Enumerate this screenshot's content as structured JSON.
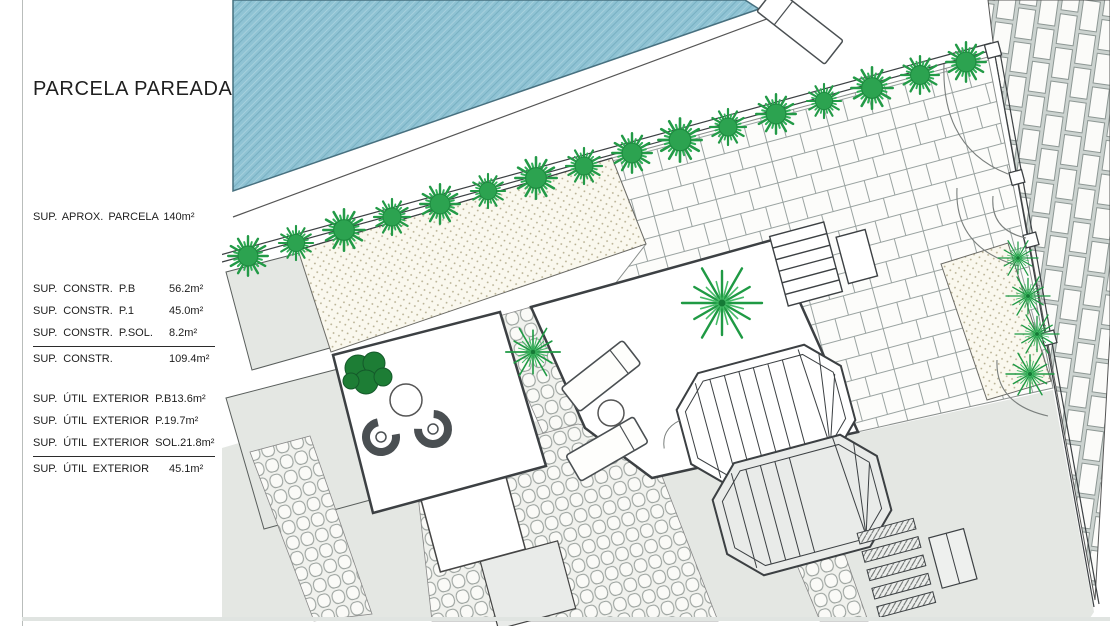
{
  "panel": {
    "title": "PARCELA PAREADA",
    "parcel_area": "SUP. APROX. PARCELA 140m²",
    "constructed": {
      "rows": [
        {
          "label": "SUP. CONSTR. P.B",
          "value": "56.2m²"
        },
        {
          "label": "SUP. CONSTR. P.1",
          "value": "45.0m²"
        },
        {
          "label": "SUP. CONSTR. P.SOL.",
          "value": "8.2m²"
        }
      ],
      "total": {
        "label": "SUP. CONSTR.",
        "value": "109.4m²"
      }
    },
    "exterior": {
      "rows": [
        {
          "label": "SUP. ÚTIL EXTERIOR P.B",
          "value": "13.6m²"
        },
        {
          "label": "SUP. ÚTIL EXTERIOR P.1",
          "value": "9.7m²"
        },
        {
          "label": "SUP. ÚTIL EXTERIOR SOL.",
          "value": "21.8m²"
        }
      ],
      "total": {
        "label": "SUP. ÚTIL EXTERIOR",
        "value": "45.1m²"
      }
    }
  },
  "plan": {
    "colors": {
      "pool_blue": "#8fc3d4",
      "plant_green": "#2aa14c",
      "parcel_grey": "#e4e7e3",
      "line_dark": "#3c4043"
    },
    "features": [
      "swimming-pool",
      "pool-lounger",
      "hedge-row",
      "paved-courtyard",
      "gravel-planter",
      "cobblestone-paths",
      "brick-sidewalk",
      "winding-stairs",
      "sun-loungers",
      "garden-table",
      "palm-trees",
      "entry-gates"
    ]
  }
}
